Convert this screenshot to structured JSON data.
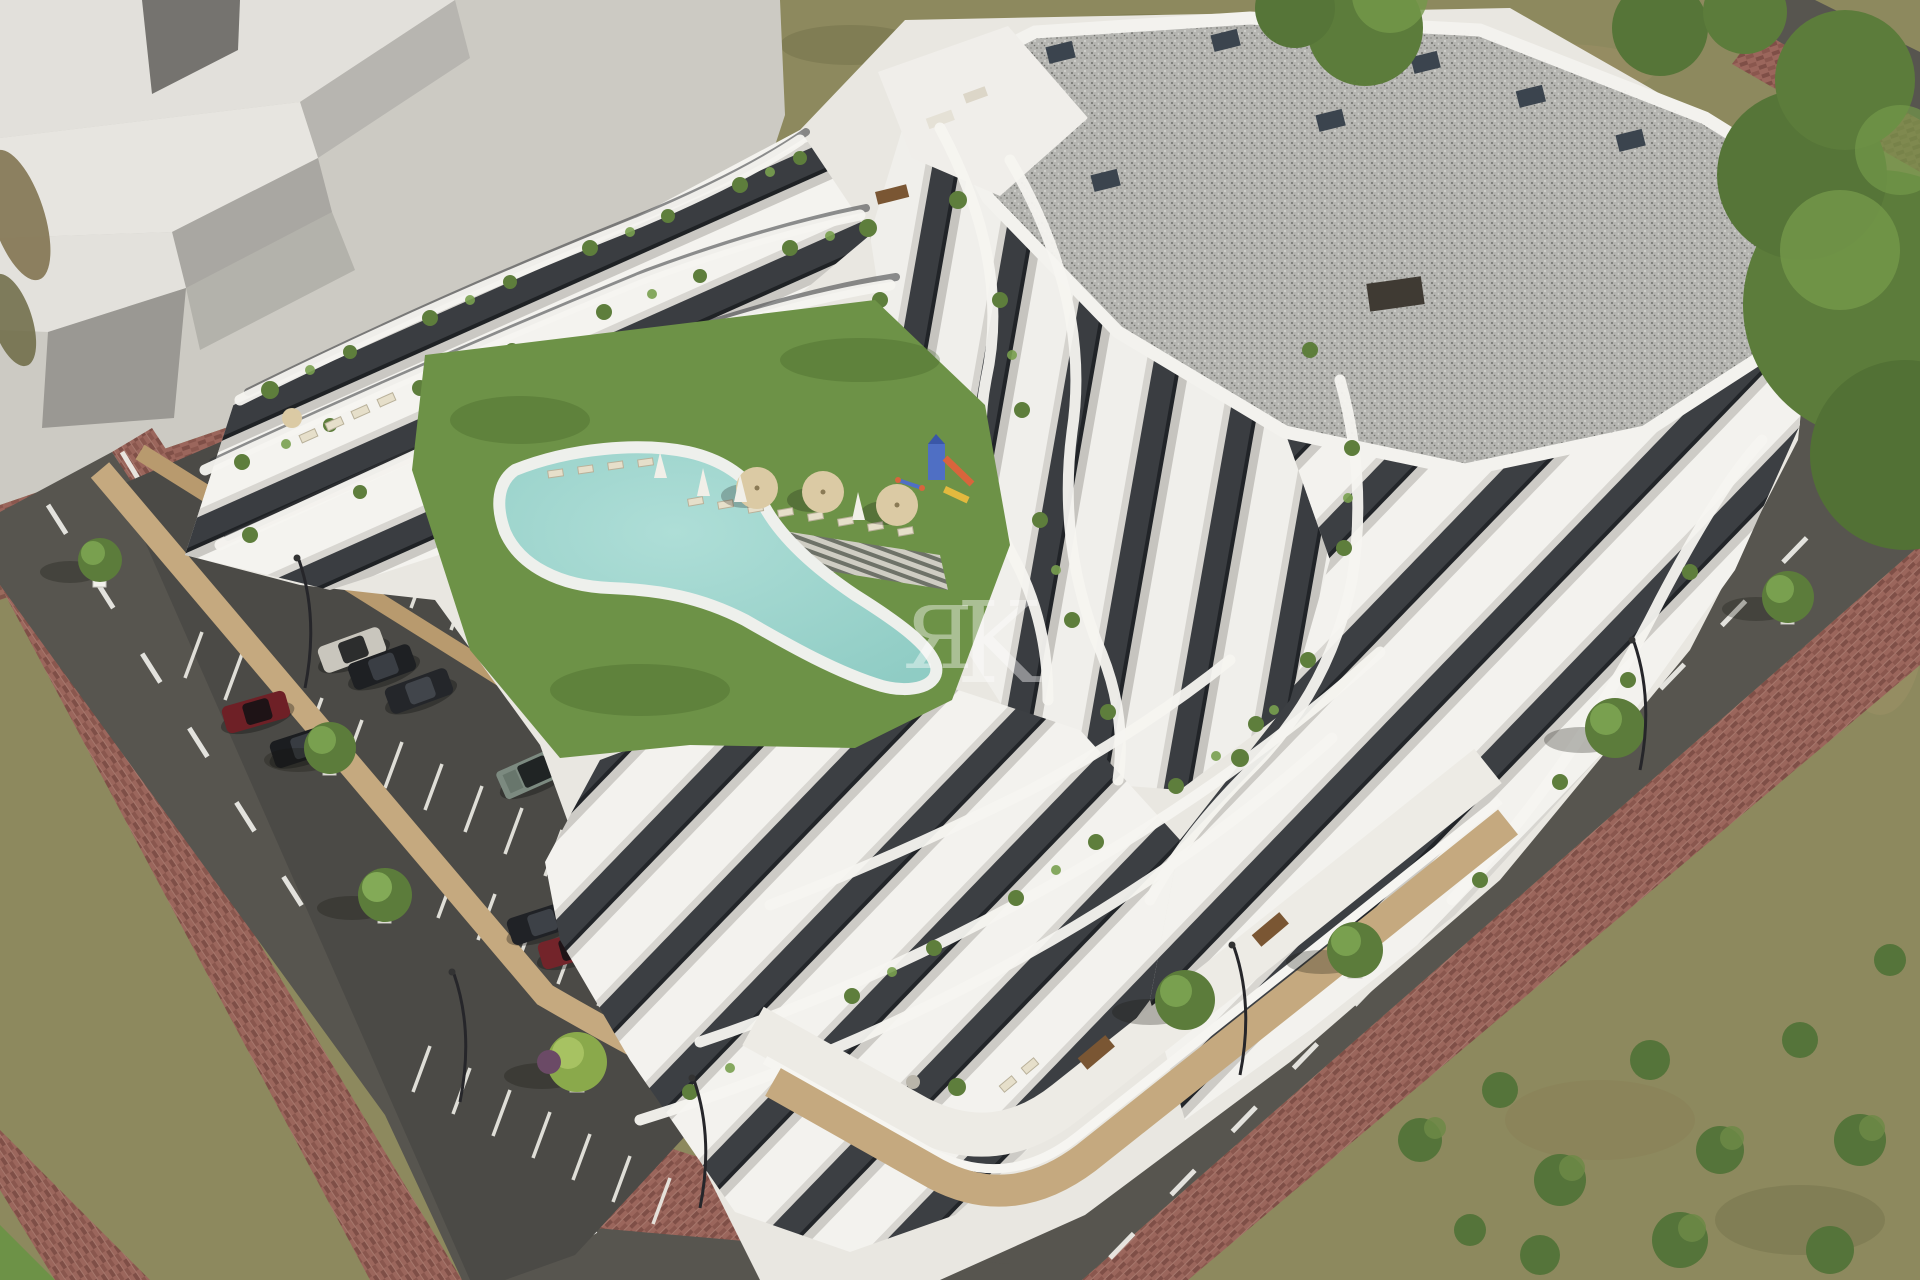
{
  "scene": {
    "description": "Aerial 3D architectural rendering of a modern white terraced apartment complex with curved balcony bands, rooftop terraces with plants, a communal lawn with kidney-shaped swimming pool, playground, sun loungers and parasols, a private parking lot with cars, and surrounding streets with red-brick sidewalks and trees",
    "watermark": {
      "left_letter": "Я",
      "right_letter": "K",
      "color": "#ffffff"
    }
  },
  "palette": {
    "dry_grass": "#8d895e",
    "dry_patch": "#9c9066",
    "dry_patch_dark": "#76744c",
    "plaza": "#cccac3",
    "massing_top": "#e2e0db",
    "massing_side": "#b7b5b0",
    "massing_front": "#9a9893",
    "massing_dark": "#75736f",
    "lawn": "#6d9247",
    "lawn_shade": "#5c8039",
    "pool_water": "#aeded7",
    "pool_deep": "#8fccc4",
    "pool_deck": "#eef0ec",
    "asphalt_road": "#57554f",
    "asphalt_parking": "#4b4a46",
    "road_marking": "#efefe9",
    "sidewalk_brick": "#9b665c",
    "sidewalk_brick_dark": "#7f4f47",
    "tan_wall": "#c5a97f",
    "tan_wall_shade": "#a98e66",
    "building_base": "#e9e7e1",
    "building_white": "#f4f3ef",
    "building_shade": "#d8d6d1",
    "facade_dark": "#3a3d41",
    "gravel_roof": "#b5b5b1",
    "chimney": "#3b444e",
    "plant_dark": "#4a6a30",
    "plant_mid": "#5e7e3c",
    "plant_light": "#79a04f",
    "tree_canopy": "#5c7c3b",
    "umbrella_tan": "#dbcaa4",
    "shadow": "rgba(25,24,20,0.42)"
  },
  "vehicles": [
    {
      "id": "car-silver",
      "color": "#c9c6bd"
    },
    {
      "id": "car-black-1",
      "color": "#1e2023"
    },
    {
      "id": "car-black-2",
      "color": "#24262a"
    },
    {
      "id": "car-red-1",
      "color": "#6e2026"
    },
    {
      "id": "car-black-3",
      "color": "#1b1d20"
    },
    {
      "id": "car-jeep",
      "color": "#7c8a80"
    },
    {
      "id": "car-black-4",
      "color": "#202226"
    },
    {
      "id": "car-red-2",
      "color": "#73242a"
    }
  ],
  "site": {
    "parked_cars": 8,
    "tan_parasols": 3,
    "folded_parasols": 4,
    "street_trees": 8,
    "street_lamps": 5,
    "pool": "kidney-shaped",
    "playground": "slide tower"
  }
}
